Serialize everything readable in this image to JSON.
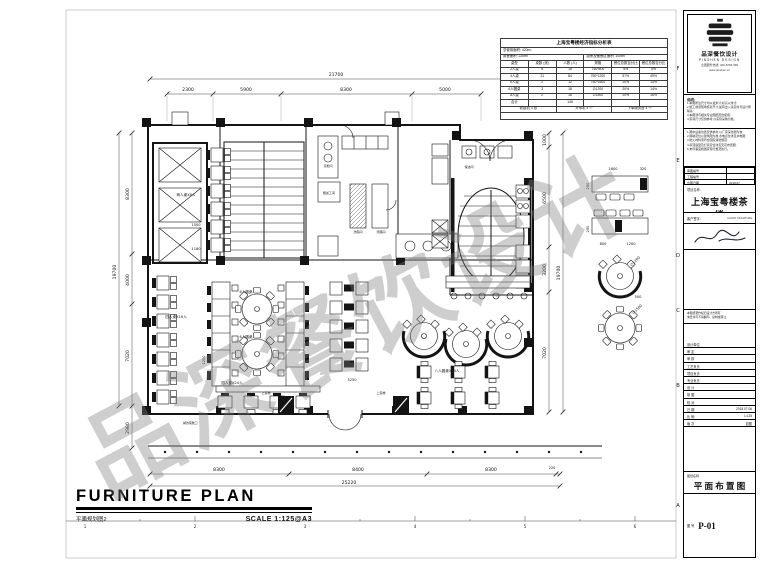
{
  "watermark": "品深餐饮设计",
  "ind": {
    "title": "上海宝粤楼经济指标分析表",
    "line1": "总使用面积: 420m²",
    "line2a": "用餐面积: 220m²",
    "line2b": "厨房及备餐区面积: 100m²",
    "headers": [
      "桌型",
      "桌数 (张)",
      "人数 (人)",
      "规格",
      "餐位总数百分比",
      "餐位总数百分比"
    ],
    "rows": [
      [
        "2人桌",
        "8",
        "16",
        "750*800",
        "5%",
        "5%"
      ],
      [
        "4人桌",
        "21",
        "84",
        "750*1200",
        "57%",
        "49%"
      ],
      [
        "6人桌",
        "2",
        "12",
        "750*1600",
        "20%",
        "14%"
      ],
      [
        "6人圆桌",
        "3",
        "18",
        "∅1200",
        "20%",
        "14%"
      ],
      [
        "8人桌",
        "2",
        "16",
        "∅1500",
        "20%",
        "16%"
      ],
      [
        "合计",
        "",
        "146",
        "",
        "",
        ""
      ]
    ],
    "foot": [
      "收银机 3 台",
      "开水机 4 个",
      "下单服务台 4 个"
    ]
  },
  "tb": {
    "company": {
      "name": "品深餐饮设计",
      "en": "PINSHEN DESIGN",
      "tel": "全国服务热线: 400-8766-399",
      "web": "www.pinshen.cn"
    },
    "notes1": {
      "title": "说明:",
      "l0": "1.本图所注尺寸均以毫米计,标高以米计;",
      "l1": "2.施工前须现场核对尺寸,如有出入请及时与设计师联系;",
      "l2": "3.本图须与相关专业图纸配合使用;",
      "l3": "4.家具尺寸仅供参考,以实际采购为准。"
    },
    "notes2": {
      "l0": "1.图中设备位置仅供参考,以厂家深化图为准;",
      "l1": "2.隔墙定位以建筑图为准,水电点位详见水电图;",
      "l2": "3.防火材料须符合国家消防规范;",
      "l3": "4.吊顶造型及灯具定位详见天花布置图;",
      "l4": "5.未尽事宜按国家现行规范执行。"
    },
    "mini": [
      [
        "审图编号",
        ""
      ],
      [
        "工程编号",
        ""
      ],
      [
        "出图日期",
        "2018.07"
      ]
    ],
    "project": {
      "label": "项目名称:",
      "name": "上海宝粤楼茶楼"
    },
    "client": {
      "label": "客户签字:",
      "en": "CLIENT SIGNATURE"
    },
    "copyright": {
      "l0": "本图纸著作权归设计方所有",
      "l1": "未经许可不得翻印、复制或转让"
    },
    "fields": [
      [
        "设计单位",
        ""
      ],
      [
        "审 定",
        ""
      ],
      [
        "审 核",
        ""
      ],
      [
        "工艺负责",
        ""
      ],
      [
        "项目负责",
        ""
      ],
      [
        "专业负责",
        ""
      ],
      [
        "设 计",
        ""
      ],
      [
        "制 图",
        ""
      ],
      [
        "校 对",
        ""
      ],
      [
        "日 期",
        "2018.07.06"
      ],
      [
        "比 例",
        "1:125"
      ],
      [
        "版 次",
        "如图"
      ]
    ],
    "drawing": {
      "label": "图纸名称",
      "name": "平 面 布 置 图",
      "no_label": "图 号",
      "no": "P-01"
    }
  },
  "footer": {
    "title": "FURNITURE PLAN",
    "cn": "平面规划图2",
    "scale": "SCALE  1:125@A3"
  },
  "svg": {
    "dims": {
      "top_overall": "21700",
      "top": [
        "2300",
        "5900",
        "8300",
        "5000"
      ],
      "left_overall": "19700",
      "left": [
        "8300",
        "4000",
        "7020",
        "2980"
      ],
      "right_overall": "19700",
      "right": [
        "1000",
        "6500",
        "3200",
        "7020"
      ],
      "bottom_overall": "25220",
      "bottom": [
        "8300",
        "8400",
        "8300",
        "220"
      ],
      "inner": [
        "1500",
        "1180",
        "1200",
        "3250"
      ]
    },
    "legend": {
      "a_top": "1600",
      "a_top2": "320",
      "a_side": "250",
      "b_b1": "800",
      "b_b2": "1200",
      "b_side": "250",
      "c_dia": "∅1200",
      "c_dim": "500",
      "d_dia": "∅1500"
    },
    "labels": {
      "two_p": "两人桌X8人",
      "four_p": "四人桌X16人",
      "round6a": "6人圆桌",
      "round6b": "6人圆桌",
      "round8": "八人圆桌X24人",
      "four_p2": "四人桌X24人",
      "steam": "蒸柜间",
      "prep": "粗加工间",
      "dish": "洗碗间",
      "roast": "烧腊间",
      "clean": "保洁间",
      "lift1": "上菜梯",
      "lift2": "上菜梯",
      "exit": "消防疏散口"
    },
    "refs": {
      "letters": [
        "F",
        "E",
        "D",
        "C",
        "B",
        "A"
      ],
      "numbers": [
        "1",
        "2",
        "3",
        "4",
        "5",
        "6"
      ]
    }
  }
}
